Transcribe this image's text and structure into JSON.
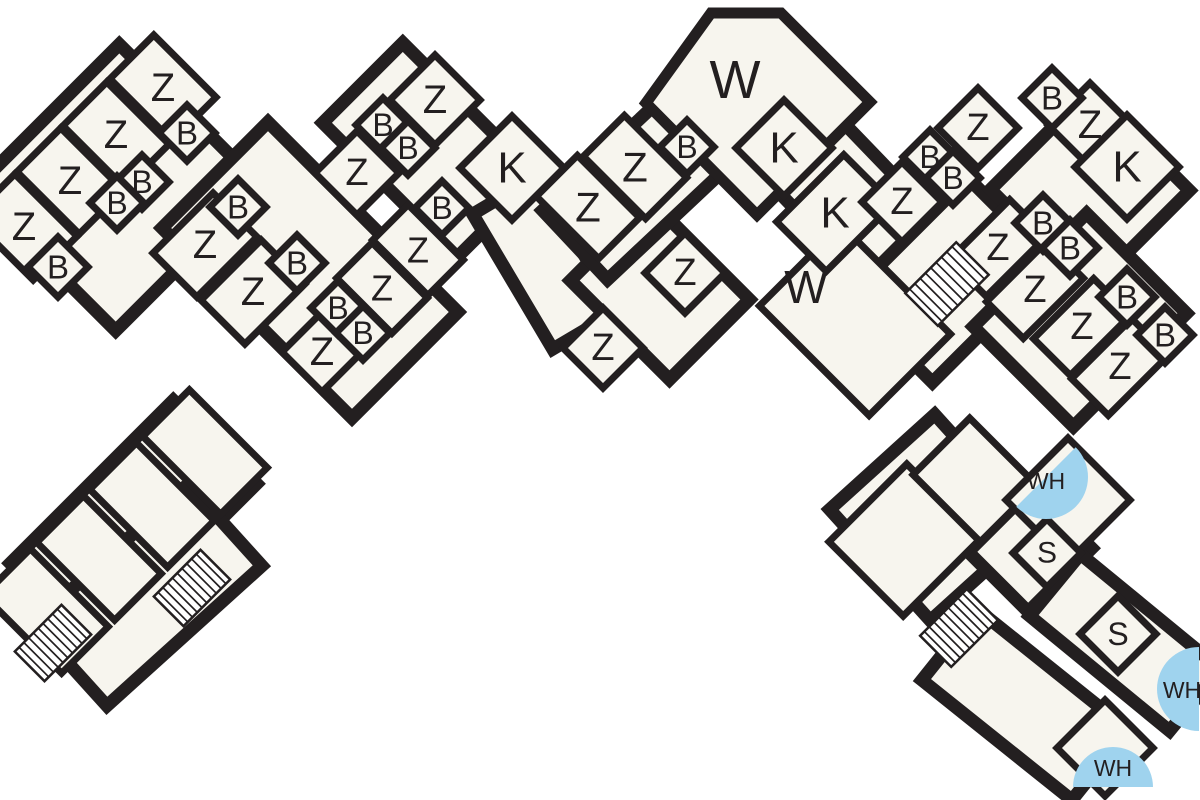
{
  "page": {
    "kind": "architectural-floor-plan",
    "background": "#ffffff"
  },
  "plan": {
    "canvas": {
      "w": 1200,
      "h": 800
    },
    "colors": {
      "wall": "#231f20",
      "room_fill": "#f7f5ee",
      "water_blue": "#9fd3ee",
      "text": "#231f20",
      "background": "#ffffff"
    },
    "stroke": {
      "outer": 13,
      "room": 7,
      "wing": 11,
      "stair_box": 2.5,
      "stair_line": 1.7
    },
    "strips": [
      {
        "x1": 45,
        "y1": 260,
        "x2": 190,
        "y2": 115,
        "w": 200
      },
      {
        "x1": 215,
        "y1": 175,
        "x2": 405,
        "y2": 365,
        "w": 150
      },
      {
        "x1": 390,
        "y1": 190,
        "x2": 470,
        "y2": 110,
        "w": 190
      },
      {
        "x1": 505,
        "y1": 195,
        "x2": 585,
        "y2": 330,
        "w": 75
      },
      {
        "x1": 620,
        "y1": 330,
        "x2": 700,
        "y2": 250,
        "w": 140
      },
      {
        "x1": 575,
        "y1": 245,
        "x2": 742,
        "y2": 88,
        "w": 95
      },
      {
        "x1": 775,
        "y1": 120,
        "x2": 905,
        "y2": 255,
        "w": 95
      },
      {
        "x1": 890,
        "y1": 340,
        "x2": 1010,
        "y2": 220,
        "w": 120
      },
      {
        "x1": 1040,
        "y1": 140,
        "x2": 1140,
        "y2": 240,
        "w": 140
      },
      {
        "x1": 1030,
        "y1": 270,
        "x2": 1130,
        "y2": 370,
        "w": 160
      },
      {
        "x1": 52,
        "y1": 605,
        "x2": 215,
        "y2": 442,
        "w": 118
      },
      {
        "x1": 70,
        "y1": 665,
        "x2": 225,
        "y2": 525,
        "w": 110
      },
      {
        "x1": 880,
        "y1": 565,
        "x2": 985,
        "y2": 470,
        "w": 150
      },
      {
        "x1": 1000,
        "y1": 520,
        "x2": 1060,
        "y2": 580,
        "w": 90
      },
      {
        "x1": 1055,
        "y1": 585,
        "x2": 1195,
        "y2": 700,
        "w": 80
      },
      {
        "x1": 950,
        "y1": 645,
        "x2": 1100,
        "y2": 765,
        "w": 90
      }
    ],
    "wings": [
      {
        "name": "living-room-W-top",
        "points": [
          [
            646,
            103
          ],
          [
            711,
            13
          ],
          [
            781,
            13
          ],
          [
            870,
            102
          ],
          [
            757,
            215
          ]
        ]
      }
    ],
    "rooms": [
      {
        "k": "rr",
        "x": 855,
        "y": 320,
        "w": 115,
        "d": 155,
        "name": "room-W-lower"
      },
      {
        "k": "rr",
        "x": 835,
        "y": 213,
        "w": 95,
        "d": 70,
        "name": "room-K"
      },
      {
        "k": "rr",
        "x": 163,
        "y": 88,
        "w": 62,
        "d": 88,
        "name": "room-Z"
      },
      {
        "k": "rr",
        "x": 116,
        "y": 135,
        "w": 62,
        "d": 88,
        "name": "room-Z"
      },
      {
        "k": "rr",
        "x": 70,
        "y": 181,
        "w": 62,
        "d": 88,
        "name": "room-Z"
      },
      {
        "k": "rr",
        "x": 24,
        "y": 227,
        "w": 62,
        "d": 88,
        "name": "room-Z"
      },
      {
        "k": "rr",
        "x": 205,
        "y": 245,
        "w": 85,
        "d": 62,
        "name": "room-Z"
      },
      {
        "k": "rr",
        "x": 253,
        "y": 292,
        "w": 85,
        "d": 62,
        "name": "room-Z"
      },
      {
        "k": "d",
        "x": 322,
        "y": 352,
        "h": 40,
        "name": "room-Z"
      },
      {
        "k": "rr",
        "x": 418,
        "y": 250,
        "w": 50,
        "d": 78,
        "name": "room-Z"
      },
      {
        "k": "rr",
        "x": 382,
        "y": 288,
        "w": 50,
        "d": 78,
        "name": "room-Z"
      },
      {
        "k": "d",
        "x": 357,
        "y": 173,
        "h": 42,
        "name": "room-Z"
      },
      {
        "k": "d",
        "x": 435,
        "y": 100,
        "h": 45,
        "name": "room-Z"
      },
      {
        "k": "rr",
        "x": 588,
        "y": 207,
        "w": 58,
        "d": 88,
        "name": "room-Z"
      },
      {
        "k": "rr",
        "x": 635,
        "y": 167,
        "w": 58,
        "d": 88,
        "name": "room-Z"
      },
      {
        "k": "d",
        "x": 603,
        "y": 348,
        "h": 40,
        "name": "room-Z"
      },
      {
        "k": "d",
        "x": 685,
        "y": 273,
        "h": 40,
        "name": "room-Z"
      },
      {
        "k": "d",
        "x": 902,
        "y": 202,
        "h": 40,
        "name": "room-Z"
      },
      {
        "k": "d",
        "x": 978,
        "y": 128,
        "h": 40,
        "name": "room-Z"
      },
      {
        "k": "d",
        "x": 1090,
        "y": 125,
        "h": 42,
        "name": "room-Z"
      },
      {
        "k": "rr",
        "x": 998,
        "y": 248,
        "w": 85,
        "d": 52,
        "name": "room-Z"
      },
      {
        "k": "rr",
        "x": 1035,
        "y": 290,
        "w": 85,
        "d": 52,
        "name": "room-Z"
      },
      {
        "k": "rr",
        "x": 1082,
        "y": 327,
        "w": 85,
        "d": 52,
        "name": "room-Z"
      },
      {
        "k": "rr",
        "x": 1120,
        "y": 367,
        "w": 85,
        "d": 52,
        "name": "room-Z"
      },
      {
        "k": "d",
        "x": 512,
        "y": 168,
        "h": 52,
        "name": "room-K"
      },
      {
        "k": "d",
        "x": 784,
        "y": 148,
        "h": 48,
        "name": "room-K"
      },
      {
        "k": "d",
        "x": 1127,
        "y": 167,
        "h": 52,
        "name": "room-K"
      },
      {
        "k": "rr",
        "x": 205,
        "y": 452,
        "w": 66,
        "d": 110,
        "name": "room-unlabeled"
      },
      {
        "k": "rr",
        "x": 152,
        "y": 505,
        "w": 66,
        "d": 110,
        "name": "room-unlabeled"
      },
      {
        "k": "rr",
        "x": 99,
        "y": 558,
        "w": 66,
        "d": 110,
        "name": "room-unlabeled"
      },
      {
        "k": "rr",
        "x": 46,
        "y": 611,
        "w": 66,
        "d": 110,
        "name": "room-unlabeled"
      },
      {
        "k": "rr",
        "x": 905,
        "y": 540,
        "w": 110,
        "d": 105,
        "name": "room-unlabeled"
      },
      {
        "k": "rr",
        "x": 975,
        "y": 480,
        "w": 80,
        "d": 95,
        "name": "room-unlabeled"
      },
      {
        "k": "d",
        "x": 1068,
        "y": 500,
        "h": 62,
        "name": "room-WH"
      },
      {
        "k": "d",
        "x": 1105,
        "y": 748,
        "h": 48,
        "name": "room-WH"
      },
      {
        "k": "d",
        "x": 187,
        "y": 133,
        "h": 28,
        "name": "room-B"
      },
      {
        "k": "d",
        "x": 142,
        "y": 182,
        "h": 27,
        "name": "room-B"
      },
      {
        "k": "d",
        "x": 117,
        "y": 203,
        "h": 27,
        "name": "room-B"
      },
      {
        "k": "d",
        "x": 58,
        "y": 267,
        "h": 30,
        "name": "room-B"
      },
      {
        "k": "d",
        "x": 238,
        "y": 207,
        "h": 28,
        "name": "room-B"
      },
      {
        "k": "d",
        "x": 297,
        "y": 263,
        "h": 28,
        "name": "room-B"
      },
      {
        "k": "d",
        "x": 338,
        "y": 308,
        "h": 27,
        "name": "room-B"
      },
      {
        "k": "d",
        "x": 363,
        "y": 333,
        "h": 27,
        "name": "room-B"
      },
      {
        "k": "d",
        "x": 383,
        "y": 125,
        "h": 27,
        "name": "room-B"
      },
      {
        "k": "d",
        "x": 408,
        "y": 148,
        "h": 27,
        "name": "room-B"
      },
      {
        "k": "d",
        "x": 442,
        "y": 208,
        "h": 27,
        "name": "room-B"
      },
      {
        "k": "d",
        "x": 687,
        "y": 147,
        "h": 27,
        "name": "room-B"
      },
      {
        "k": "d",
        "x": 930,
        "y": 157,
        "h": 27,
        "name": "room-B"
      },
      {
        "k": "d",
        "x": 953,
        "y": 178,
        "h": 27,
        "name": "room-B"
      },
      {
        "k": "d",
        "x": 1052,
        "y": 98,
        "h": 30,
        "name": "room-B"
      },
      {
        "k": "d",
        "x": 1043,
        "y": 223,
        "h": 28,
        "name": "room-B"
      },
      {
        "k": "d",
        "x": 1070,
        "y": 248,
        "h": 28,
        "name": "room-B"
      },
      {
        "k": "d",
        "x": 1127,
        "y": 297,
        "h": 28,
        "name": "room-B"
      },
      {
        "k": "d",
        "x": 1165,
        "y": 335,
        "h": 28,
        "name": "room-B"
      },
      {
        "k": "d",
        "x": 1047,
        "y": 553,
        "h": 34,
        "name": "room-S"
      },
      {
        "k": "d",
        "x": 1118,
        "y": 634,
        "h": 38,
        "name": "room-S"
      }
    ],
    "stairs": [
      {
        "x": 947,
        "y": 284,
        "l": 72,
        "w": 46
      },
      {
        "x": 53,
        "y": 643,
        "l": 66,
        "w": 42
      },
      {
        "x": 192,
        "y": 588,
        "l": 66,
        "w": 42
      },
      {
        "x": 959,
        "y": 628,
        "l": 66,
        "w": 44
      }
    ],
    "fans": [
      {
        "x": 1046,
        "y": 477,
        "r": 42,
        "dir": "se"
      },
      {
        "x": 1199,
        "y": 689,
        "r": 42,
        "dir": "left"
      },
      {
        "x": 1113,
        "y": 787,
        "r": 40,
        "dir": "up"
      }
    ],
    "labels": [
      {
        "t": "Z",
        "x": 163,
        "y": 88,
        "s": 40
      },
      {
        "t": "Z",
        "x": 116,
        "y": 135,
        "s": 40
      },
      {
        "t": "Z",
        "x": 70,
        "y": 181,
        "s": 40
      },
      {
        "t": "Z",
        "x": 24,
        "y": 227,
        "s": 40
      },
      {
        "t": "Z",
        "x": 205,
        "y": 245,
        "s": 40
      },
      {
        "t": "Z",
        "x": 253,
        "y": 292,
        "s": 40
      },
      {
        "t": "Z",
        "x": 322,
        "y": 352,
        "s": 40
      },
      {
        "t": "Z",
        "x": 418,
        "y": 250,
        "s": 36
      },
      {
        "t": "Z",
        "x": 382,
        "y": 288,
        "s": 36
      },
      {
        "t": "Z",
        "x": 357,
        "y": 173,
        "s": 38
      },
      {
        "t": "Z",
        "x": 435,
        "y": 100,
        "s": 40
      },
      {
        "t": "Z",
        "x": 588,
        "y": 207,
        "s": 42
      },
      {
        "t": "Z",
        "x": 635,
        "y": 167,
        "s": 42
      },
      {
        "t": "Z",
        "x": 603,
        "y": 348,
        "s": 38
      },
      {
        "t": "Z",
        "x": 685,
        "y": 273,
        "s": 38
      },
      {
        "t": "Z",
        "x": 902,
        "y": 202,
        "s": 38
      },
      {
        "t": "Z",
        "x": 978,
        "y": 128,
        "s": 38
      },
      {
        "t": "Z",
        "x": 1090,
        "y": 125,
        "s": 40
      },
      {
        "t": "Z",
        "x": 998,
        "y": 248,
        "s": 38
      },
      {
        "t": "Z",
        "x": 1035,
        "y": 290,
        "s": 38
      },
      {
        "t": "Z",
        "x": 1082,
        "y": 327,
        "s": 38
      },
      {
        "t": "Z",
        "x": 1120,
        "y": 367,
        "s": 38
      },
      {
        "t": "B",
        "x": 187,
        "y": 133,
        "s": 33
      },
      {
        "t": "B",
        "x": 142,
        "y": 182,
        "s": 32
      },
      {
        "t": "B",
        "x": 117,
        "y": 203,
        "s": 32
      },
      {
        "t": "B",
        "x": 58,
        "y": 267,
        "s": 33
      },
      {
        "t": "B",
        "x": 238,
        "y": 207,
        "s": 33
      },
      {
        "t": "B",
        "x": 297,
        "y": 263,
        "s": 33
      },
      {
        "t": "B",
        "x": 338,
        "y": 308,
        "s": 32
      },
      {
        "t": "B",
        "x": 363,
        "y": 333,
        "s": 32
      },
      {
        "t": "B",
        "x": 383,
        "y": 125,
        "s": 32
      },
      {
        "t": "B",
        "x": 408,
        "y": 148,
        "s": 32
      },
      {
        "t": "B",
        "x": 442,
        "y": 208,
        "s": 32
      },
      {
        "t": "B",
        "x": 687,
        "y": 147,
        "s": 32
      },
      {
        "t": "B",
        "x": 930,
        "y": 157,
        "s": 32
      },
      {
        "t": "B",
        "x": 953,
        "y": 178,
        "s": 32
      },
      {
        "t": "B",
        "x": 1052,
        "y": 98,
        "s": 33
      },
      {
        "t": "B",
        "x": 1043,
        "y": 223,
        "s": 33
      },
      {
        "t": "B",
        "x": 1070,
        "y": 248,
        "s": 33
      },
      {
        "t": "B",
        "x": 1127,
        "y": 297,
        "s": 33
      },
      {
        "t": "B",
        "x": 1165,
        "y": 335,
        "s": 33
      },
      {
        "t": "K",
        "x": 512,
        "y": 168,
        "s": 44
      },
      {
        "t": "K",
        "x": 784,
        "y": 148,
        "s": 44
      },
      {
        "t": "K",
        "x": 835,
        "y": 213,
        "s": 44
      },
      {
        "t": "K",
        "x": 1127,
        "y": 167,
        "s": 44
      },
      {
        "t": "W",
        "x": 735,
        "y": 80,
        "s": 54
      },
      {
        "t": "W",
        "x": 806,
        "y": 287,
        "s": 46
      },
      {
        "t": "S",
        "x": 1047,
        "y": 553,
        "s": 30
      },
      {
        "t": "S",
        "x": 1118,
        "y": 634,
        "s": 32
      },
      {
        "t": "WH",
        "x": 1046,
        "y": 481,
        "s": 23
      },
      {
        "t": "WH",
        "x": 1182,
        "y": 690,
        "s": 23
      },
      {
        "t": "WH",
        "x": 1113,
        "y": 768,
        "s": 23
      }
    ]
  }
}
